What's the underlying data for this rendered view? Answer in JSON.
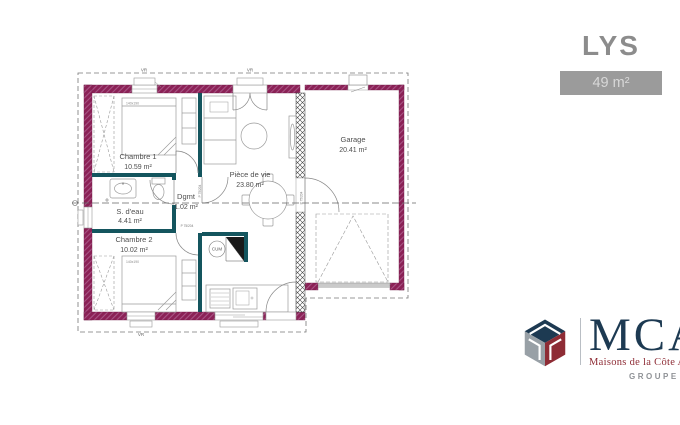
{
  "header": {
    "title": "LYS",
    "area_badge": "49 m²"
  },
  "plan": {
    "rooms": [
      {
        "id": "chambre1",
        "name": "Chambre 1",
        "area": "10.59 m²"
      },
      {
        "id": "sdeau",
        "name": "S. d'eau",
        "area": "4.41 m²"
      },
      {
        "id": "dgmt",
        "name": "Dgmt",
        "area": "1.02 m²"
      },
      {
        "id": "chambre2",
        "name": "Chambre 2",
        "area": "10.02 m²"
      },
      {
        "id": "piecedevie",
        "name": "Pièce de vie",
        "area": "23.80 m²"
      },
      {
        "id": "garage",
        "name": "Garage",
        "area": "20.41 m²"
      }
    ],
    "annotations": {
      "water_heater": "CUM",
      "bed1_size": "140x190",
      "bed2_size": "140x190",
      "window_tag": "VR",
      "door_tag": "P 75/204"
    },
    "colors": {
      "exterior_wall": "#8b2156",
      "interior_wall": "#14555e"
    }
  },
  "branding": {
    "logo": "MCA",
    "tagline": "Maisons de la Côte Atlantique",
    "group_label": "GROUPE HEXAOM",
    "logo_colors": {
      "blue": "#1d3a52",
      "red": "#8e2c35",
      "gray": "#98a0a6"
    }
  }
}
